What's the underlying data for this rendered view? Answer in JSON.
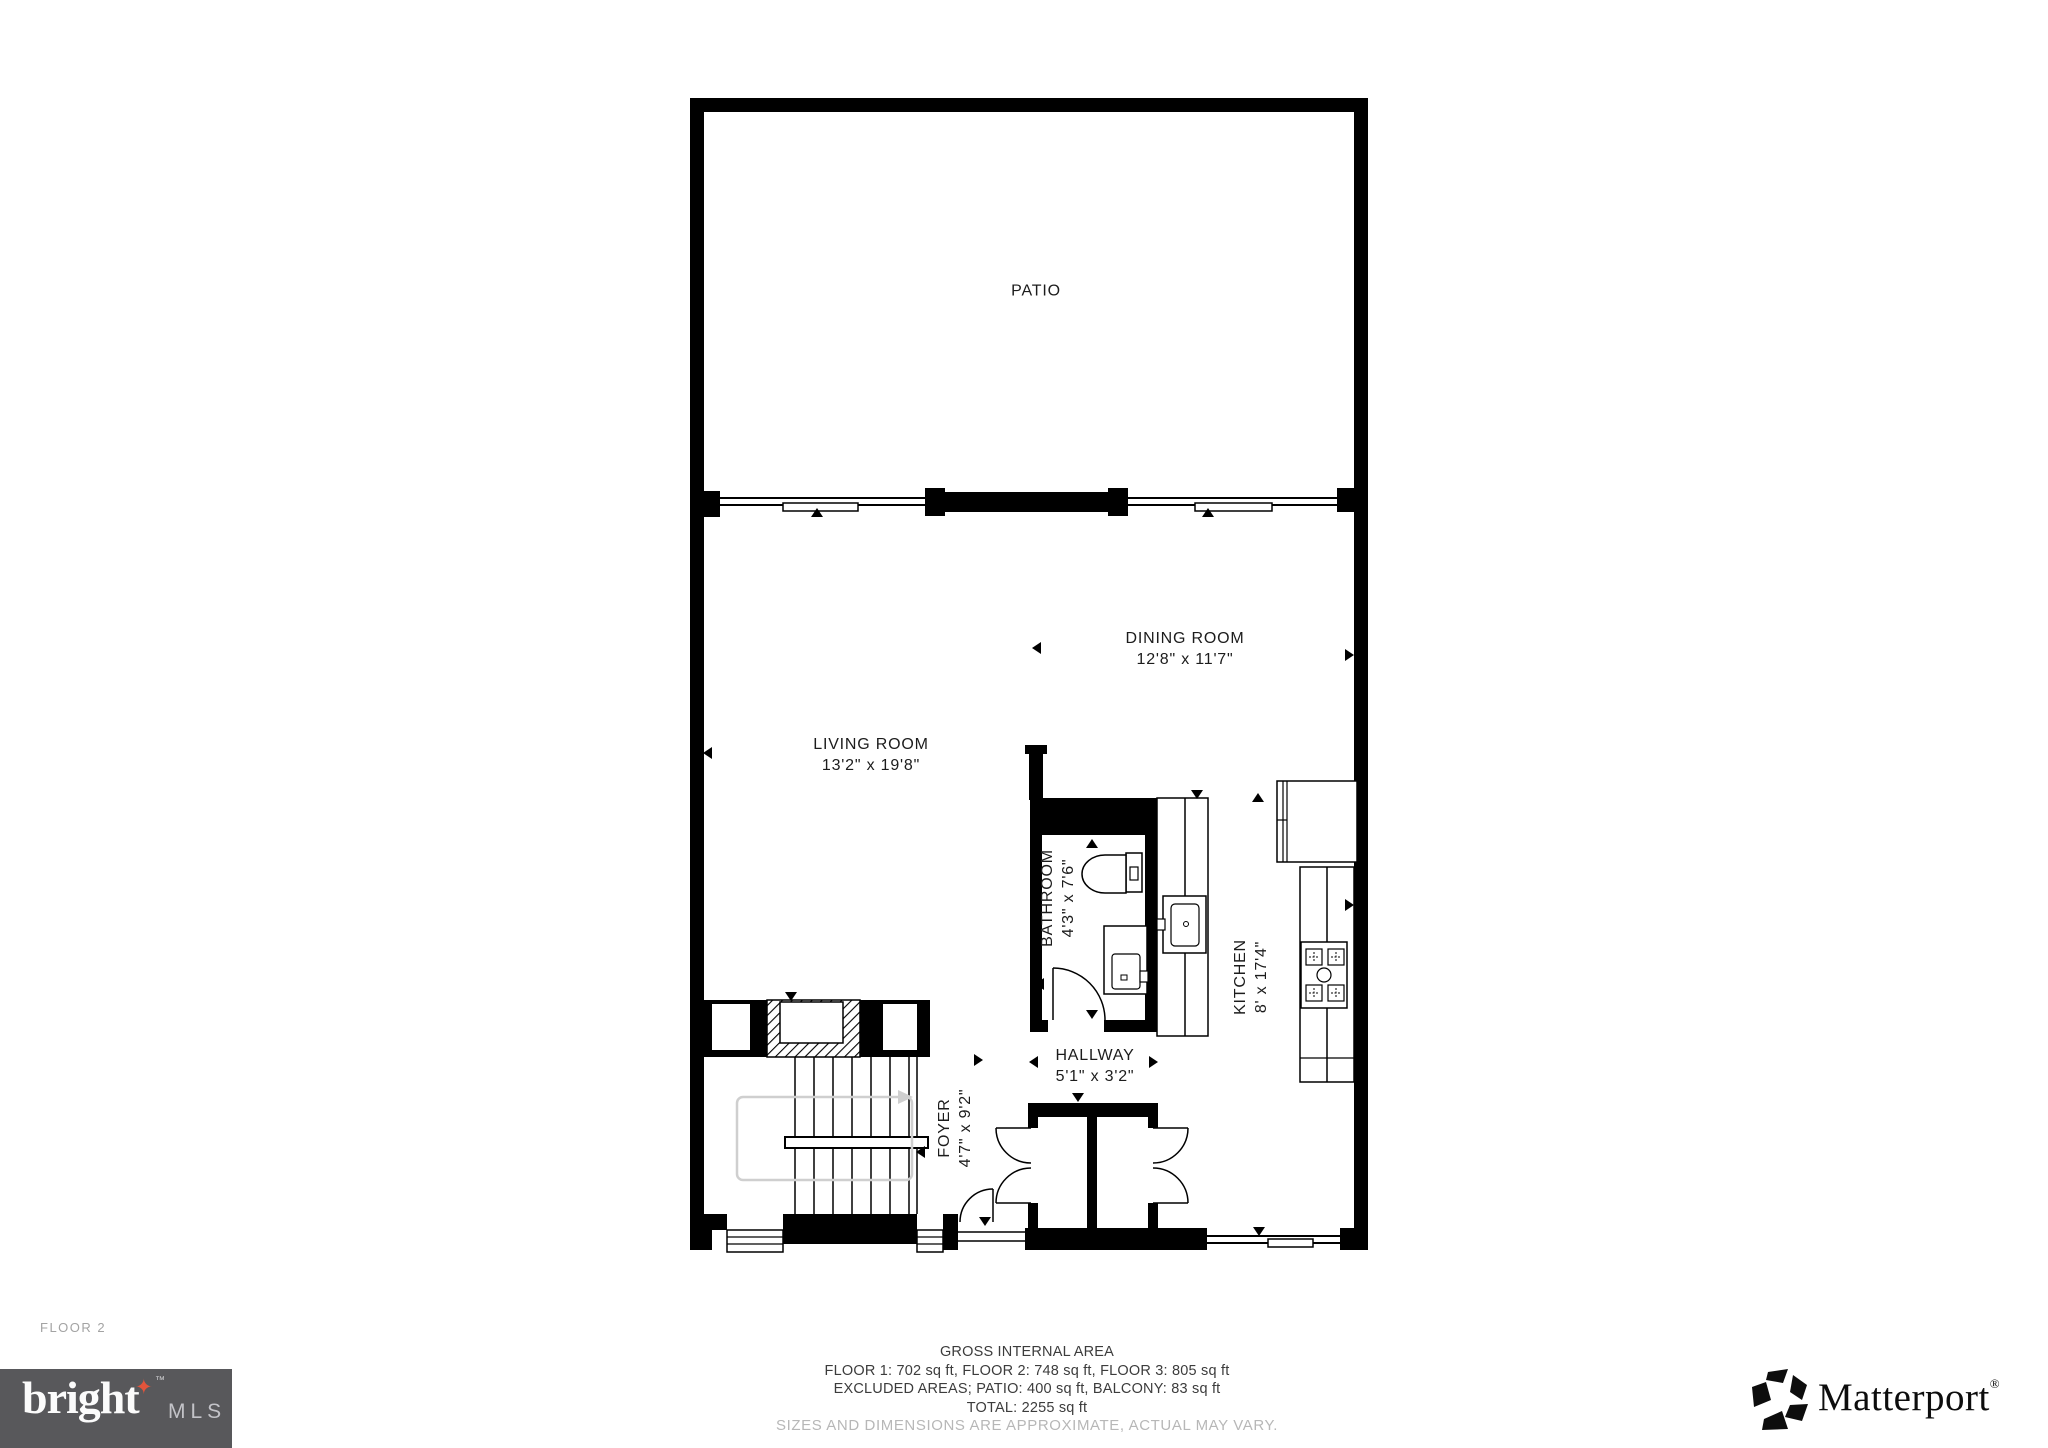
{
  "floor_label": "FLOOR 2",
  "rooms": {
    "patio": {
      "name": "PATIO",
      "dims": ""
    },
    "dining_room": {
      "name": "DINING ROOM",
      "dims": "12'8\" x 11'7\""
    },
    "living_room": {
      "name": "LIVING ROOM",
      "dims": "13'2\" x 19'8\""
    },
    "bathroom": {
      "name": "BATHROOM",
      "dims": "4'3\" x 7'6\""
    },
    "kitchen": {
      "name": "KITCHEN",
      "dims": "8' x 17'4\""
    },
    "hallway": {
      "name": "HALLWAY",
      "dims": "5'1\" x 3'2\""
    },
    "foyer": {
      "name": "FOYER",
      "dims": "4'7\" x 9'2\""
    }
  },
  "footer": {
    "line1": "GROSS INTERNAL AREA",
    "line2": "FLOOR 1: 702 sq ft, FLOOR 2: 748 sq ft, FLOOR 3: 805 sq ft",
    "line3": "EXCLUDED AREAS; PATIO: 400 sq ft, BALCONY: 83 sq ft",
    "line4": "TOTAL: 2255 sq ft",
    "disclaimer": "SIZES AND DIMENSIONS ARE APPROXIMATE, ACTUAL MAY VARY."
  },
  "branding": {
    "bright": {
      "word": "bright",
      "tm": "™",
      "suffix": "MLS",
      "star_glyph": "✦",
      "star_color": "#e2543b",
      "bg_color": "#58585b"
    },
    "matterport": {
      "name": "Matterport",
      "reg": "®"
    }
  },
  "colors": {
    "wall": "#000000",
    "label_text": "#1c1c1c",
    "footer_text": "#3c3c3c",
    "muted_text": "#b7b7b7",
    "floor_label_text": "#a3a3a3"
  }
}
